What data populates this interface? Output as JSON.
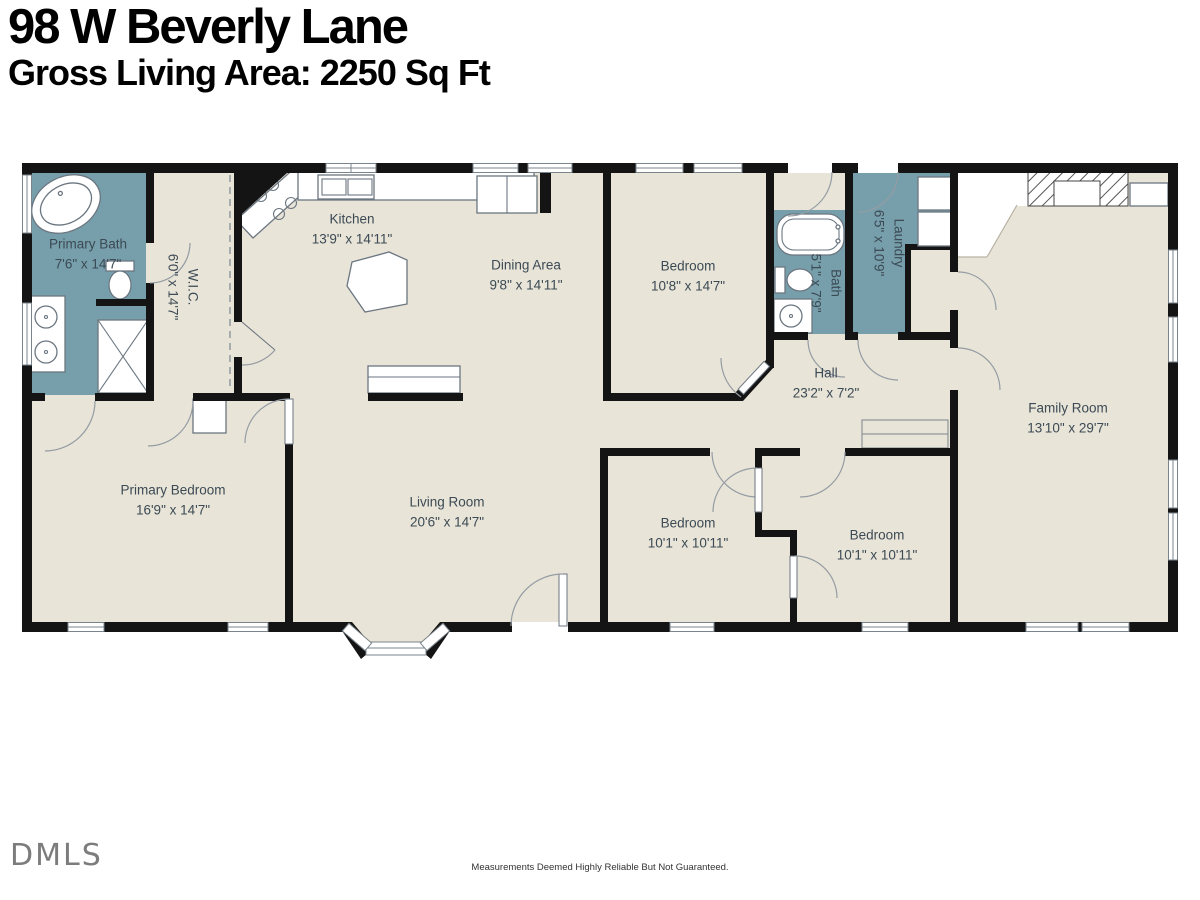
{
  "header": {
    "address": "98 W Beverly Lane",
    "gross_area": "Gross Living Area: 2250 Sq Ft"
  },
  "rooms": {
    "primary_bath": {
      "name": "Primary Bath",
      "dims": "7'6\" x 14'7\""
    },
    "wic": {
      "name": "W.I.C.",
      "dims": "6'0\" x 14'7\""
    },
    "kitchen": {
      "name": "Kitchen",
      "dims": "13'9\" x 14'11\""
    },
    "dining": {
      "name": "Dining Area",
      "dims": "9'8\" x 14'11\""
    },
    "bedroom_top": {
      "name": "Bedroom",
      "dims": "10'8\" x 14'7\""
    },
    "bath": {
      "name": "Bath",
      "dims": "5'1\" x 7'9\""
    },
    "laundry": {
      "name": "Laundry",
      "dims": "6'5\" x 10'9\""
    },
    "hall": {
      "name": "Hall",
      "dims": "23'2\" x 7'2\""
    },
    "family_room": {
      "name": "Family Room",
      "dims": "13'10\" x 29'7\""
    },
    "primary_bedroom": {
      "name": "Primary Bedroom",
      "dims": "16'9\" x 14'7\""
    },
    "living_room": {
      "name": "Living Room",
      "dims": "20'6\" x 14'7\""
    },
    "bedroom_a": {
      "name": "Bedroom",
      "dims": "10'1\" x 10'11\""
    },
    "bedroom_b": {
      "name": "Bedroom",
      "dims": "10'1\" x 10'11\""
    }
  },
  "footer": {
    "logo": "DMLS",
    "disclaimer": "Measurements Deemed Highly Reliable But Not Guaranteed."
  },
  "colors": {
    "floor": "#e9e4d8",
    "wet": "#779fab",
    "wall": "#141414",
    "label": "#3b4a54"
  }
}
